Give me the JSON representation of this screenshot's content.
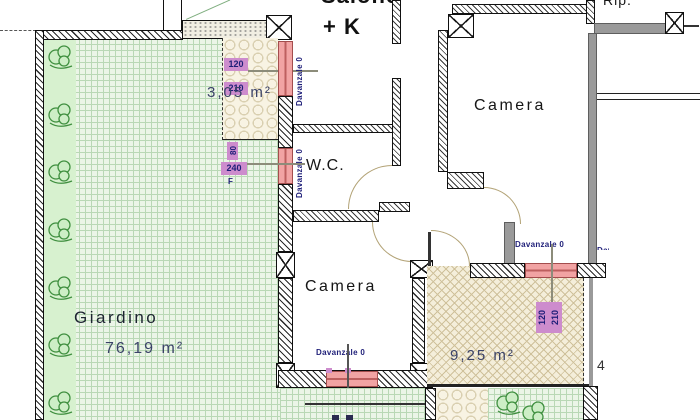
{
  "rooms": {
    "salone": {
      "label": "Salone",
      "label2": "+ K"
    },
    "camera_top": {
      "label": "Camera"
    },
    "camera_bottom": {
      "label": "Camera"
    },
    "wc": {
      "label": "W.C."
    },
    "rip": {
      "label": "Rip."
    }
  },
  "outdoor": {
    "giardino": {
      "label": "Giardino",
      "area": "76,19 m²"
    },
    "balcone": {
      "area": "3,05 m²"
    },
    "terrazza": {
      "area": "9,25 m²"
    },
    "neighbor_partial": "4"
  },
  "sill_label": "Davanzale 0",
  "window_dims": {
    "balcone": {
      "w": "120",
      "h": "210"
    },
    "wc": {
      "w": "80",
      "h": "240",
      "tag": "F"
    },
    "terrazza": {
      "w": "120",
      "h": "210"
    }
  },
  "colors": {
    "garden_fill": "#ebf5e7",
    "garden_grid": "#b9d8b5",
    "plant_green": "#3f8f3f",
    "tile_fill": "#f8f3e3",
    "crosshatch_fill": "#f4eeda",
    "window_pink": "#f1a3a3",
    "dim_purple": "#cd8ccd",
    "dim_text_navy": "#1e1e78",
    "gray_wall": "#9a9a9a",
    "area_text": "#3a4267"
  }
}
